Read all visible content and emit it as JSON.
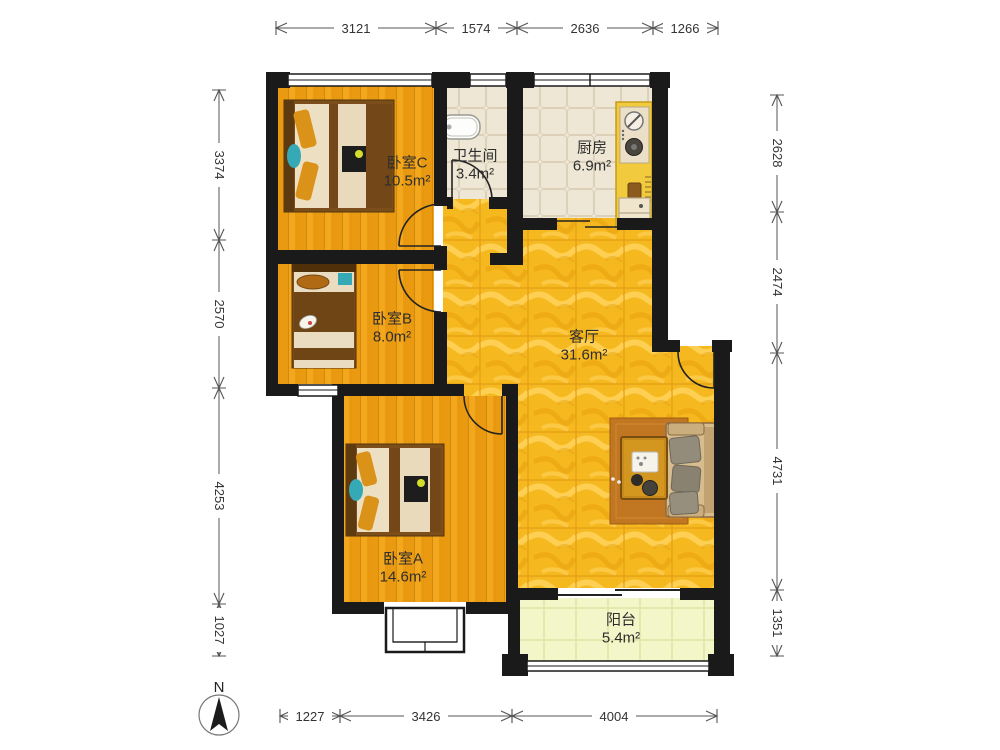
{
  "title": "apartment-floor-plan",
  "compass": {
    "label": "N"
  },
  "rooms": [
    {
      "id": "bedroom-c",
      "name": "卧室C",
      "area": "10.5m²"
    },
    {
      "id": "bathroom",
      "name": "卫生间",
      "area": "3.4m²"
    },
    {
      "id": "kitchen",
      "name": "厨房",
      "area": "6.9m²"
    },
    {
      "id": "bedroom-b",
      "name": "卧室B",
      "area": "8.0m²"
    },
    {
      "id": "living-room",
      "name": "客厅",
      "area": "31.6m²"
    },
    {
      "id": "bedroom-a",
      "name": "卧室A",
      "area": "14.6m²"
    },
    {
      "id": "balcony",
      "name": "阳台",
      "area": "5.4m²"
    }
  ],
  "dimensions": {
    "top": [
      "3121",
      "1574",
      "2636",
      "1266"
    ],
    "left": [
      "3374",
      "2570",
      "4253",
      "1027"
    ],
    "right": [
      "2628",
      "2474",
      "4731",
      "1351"
    ],
    "bottom": [
      "1227",
      "3426",
      "4004"
    ]
  },
  "colors": {
    "wall": "#1a1a1a",
    "bedroom_floor": "#EA9A10",
    "living_floor": "#F6B81F",
    "kitchen_bath_floor": "#EFE6D4",
    "balcony_floor": "#F2F6C8",
    "counter": "#F1CB3D",
    "accent_teal": "#35A9B6",
    "dim_line": "#555555"
  }
}
